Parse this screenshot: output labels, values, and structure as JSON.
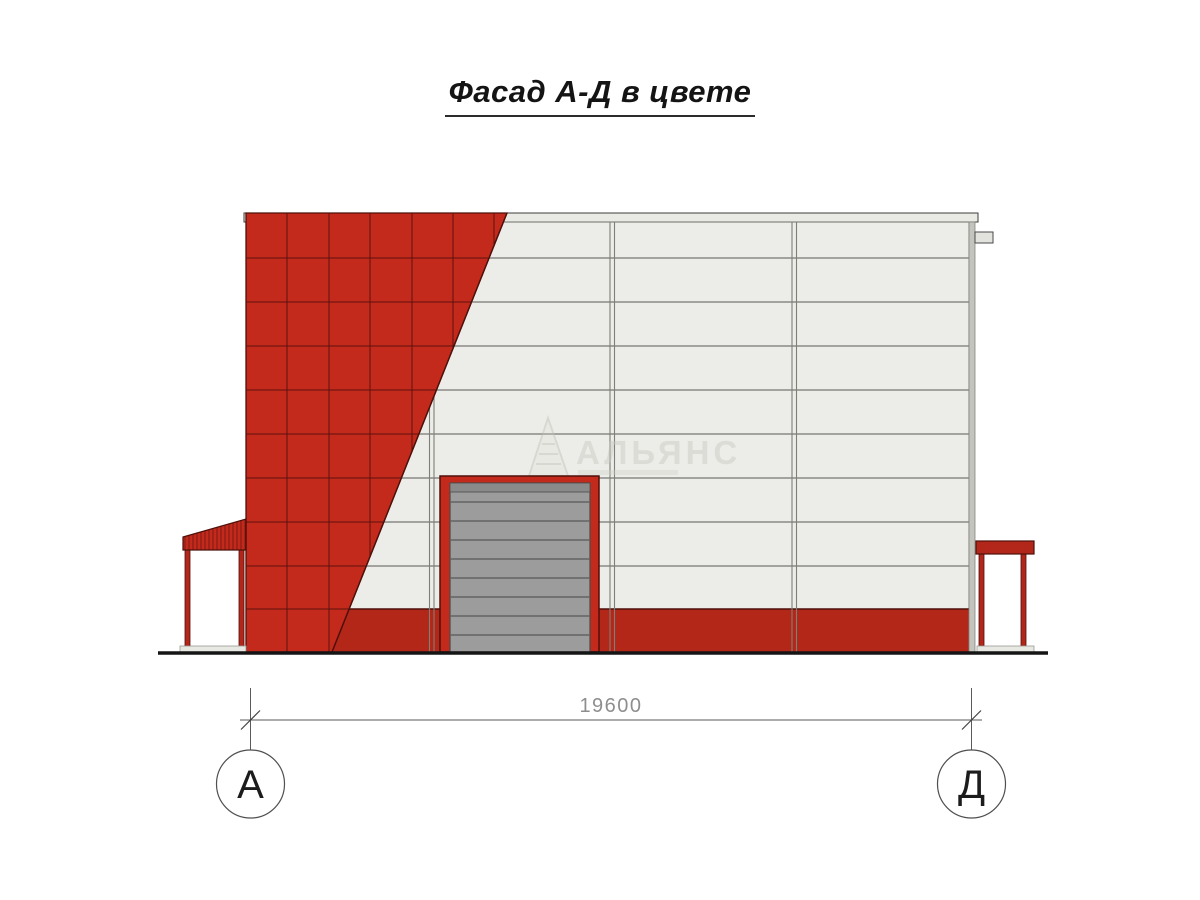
{
  "title": {
    "text": "Фасад А-Д в цвете"
  },
  "drawing": {
    "dimension": {
      "value": "19600"
    },
    "axis_markers": {
      "left": {
        "label": "А"
      },
      "right": {
        "label": "Д"
      }
    },
    "watermark": {
      "name": "АЛЬЯНС"
    }
  },
  "colors": {
    "facade_red": "#c42a1c",
    "plinth_red": "#b32719",
    "canopy_red": "#b2271a",
    "dark_red_line": "#4e100b",
    "panel_light": "#ecece8",
    "panel_line": "#8a8a85",
    "door_gray": "#9c9c9c",
    "door_bar_gray": "#8a8a8a",
    "ground_black": "#151515"
  }
}
